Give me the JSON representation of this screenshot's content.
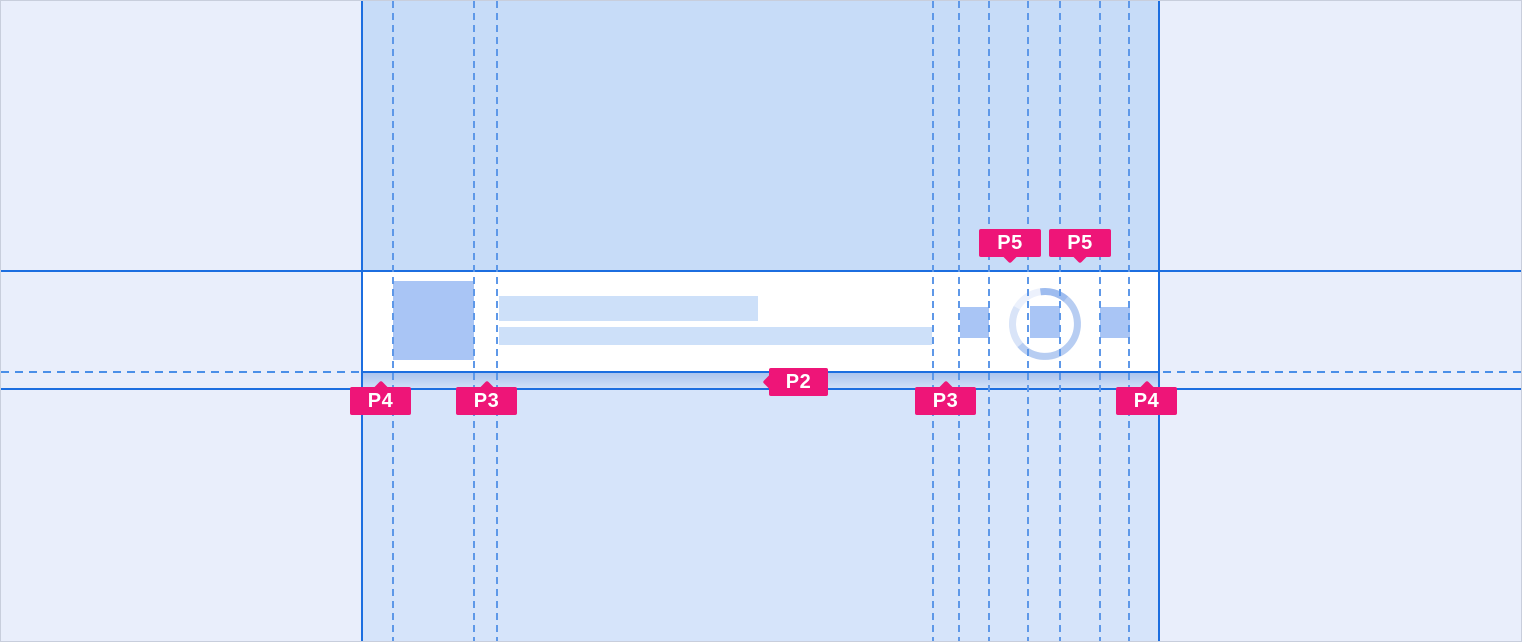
{
  "meta": {
    "view": "spacing-redline-spec",
    "component": "list-item-skeleton"
  },
  "annotations": {
    "padding_labels": [
      {
        "id": "p5-left",
        "text": "P5"
      },
      {
        "id": "p5-right",
        "text": "P5"
      },
      {
        "id": "p2",
        "text": "P2"
      },
      {
        "id": "p4-left",
        "text": "P4"
      },
      {
        "id": "p3-left",
        "text": "P3"
      },
      {
        "id": "p3-right",
        "text": "P3"
      },
      {
        "id": "p4-right",
        "text": "P4"
      }
    ]
  },
  "colors": {
    "outer_background": "#E9EEFB",
    "band_top": "#C7DCF8",
    "band_bottom": "#D6E4FA",
    "guide_solid": "#1C6EE0",
    "guide_dashed": "#5E98E8",
    "card_background": "#FFFFFF",
    "placeholder_fill": "#A9C5F5",
    "text_line_fill": "#CDE0F9",
    "spinner_light": "#ECF1FC",
    "spinner_medium": "#B7CDF2",
    "spinner_dark": "#9EBCEF",
    "annotation_pink": "#EE1578",
    "annotation_text": "#FFFFFF"
  }
}
